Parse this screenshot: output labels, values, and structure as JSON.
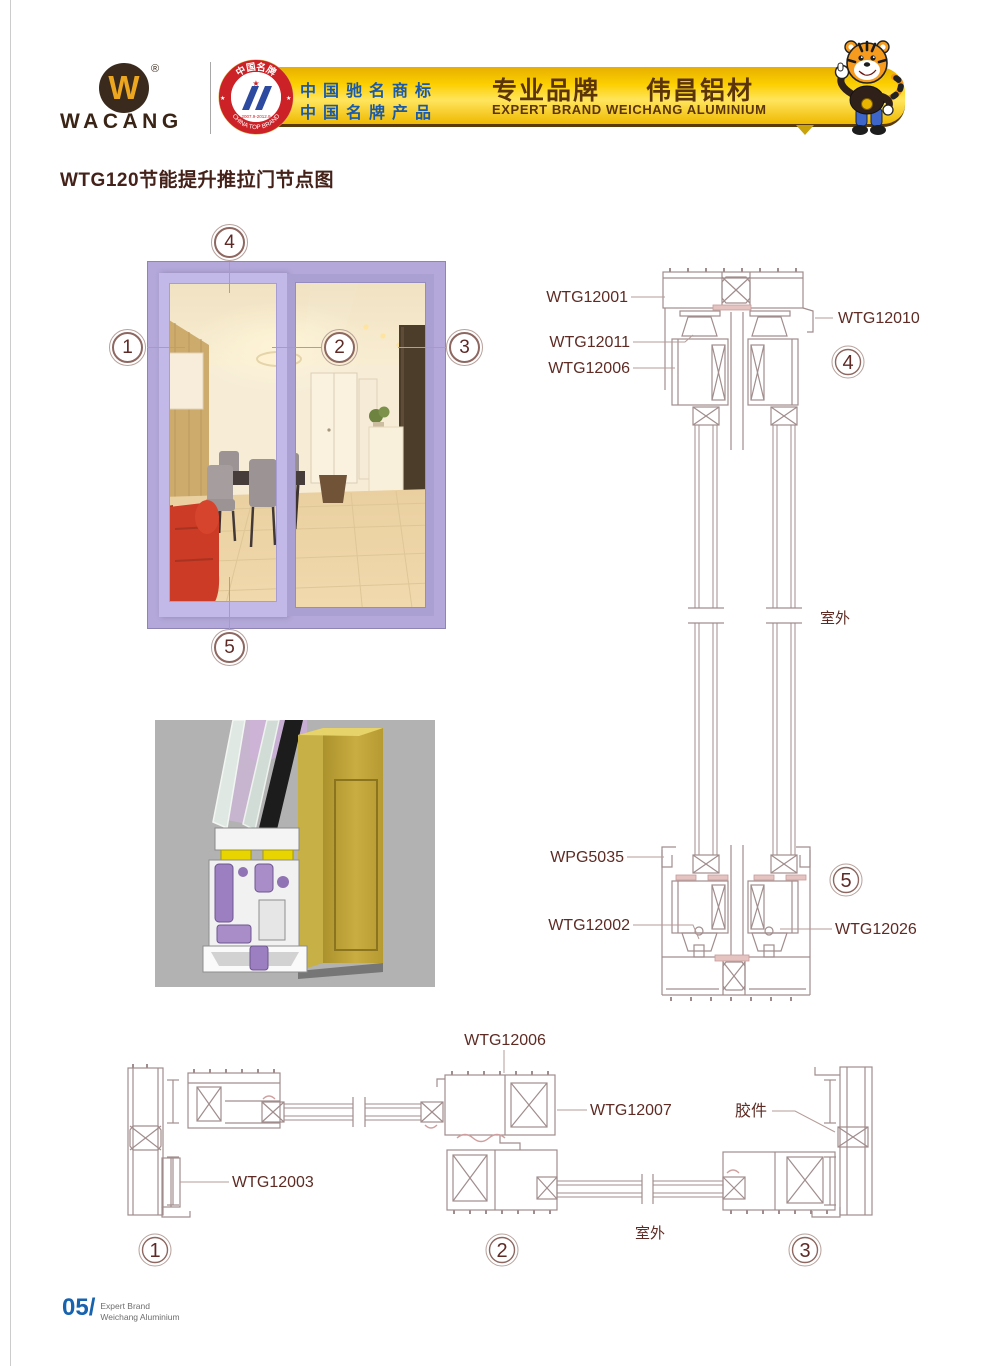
{
  "header": {
    "brand": "WACANG",
    "registered": "®",
    "logo_w": "W",
    "badge": {
      "top": "中国名牌",
      "bottom": "CHINA TOP BRAND",
      "years": "2007.9-2012.9",
      "star": "★"
    },
    "banner": {
      "row1": "中国驰名商标",
      "row2": "中国名牌产品",
      "slogan_left": "专业品牌",
      "slogan_right": "伟昌铝材",
      "slogan_en": "EXPERT BRAND WEICHANG ALUMINIUM"
    }
  },
  "title": "WTG120节能提升推拉门节点图",
  "photo": {
    "callout_1": "1",
    "callout_2": "2",
    "callout_3": "3",
    "callout_4": "4",
    "callout_5": "5"
  },
  "vsec": {
    "label_wtg12001": "WTG12001",
    "label_wtg12010": "WTG12010",
    "label_wtg12011": "WTG12011",
    "label_wtg12006": "WTG12006",
    "label_wpg5035": "WPG5035",
    "label_wtg12002": "WTG12002",
    "label_wtg12026": "WTG12026",
    "outdoor": "室外",
    "callout_top": "4",
    "callout_bottom": "5"
  },
  "hsec": {
    "label_wtg12003": "WTG12003",
    "label_wtg12006": "WTG12006",
    "label_wtg12007": "WTG12007",
    "label_jiaojian": "胶件",
    "outdoor": "室外",
    "callout_1": "1",
    "callout_2": "2",
    "callout_3": "3"
  },
  "footer": {
    "page": "05/",
    "line1": "Expert Brand",
    "line2": "Weichang Aluminium"
  },
  "colors": {
    "banner_gold": "#fccf00",
    "band_border": "#5a3a08",
    "text_blue": "#1a5aa8",
    "slogan_brown": "#5b3509",
    "title_brown": "#44221a",
    "cad_line": "#a18d8d",
    "cad_label": "#5e2b24",
    "frame_lilac": "#b3a8d9",
    "footer_blue": "#1763af",
    "badge_red": "#cc2127",
    "emblem_blue": "#2b4aa0"
  }
}
